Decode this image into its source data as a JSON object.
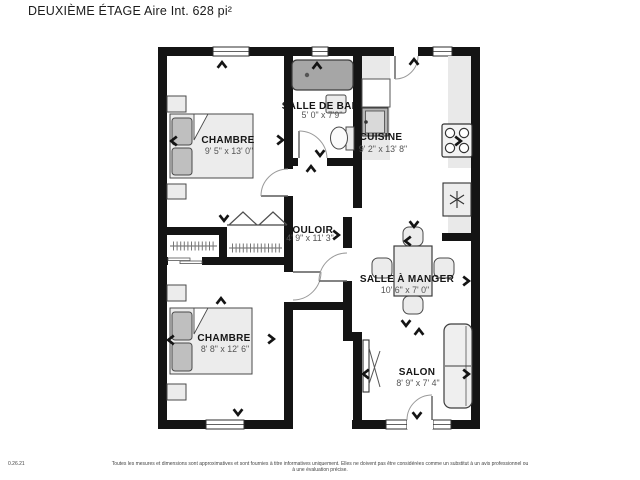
{
  "title": "DEUXIÈME ÉTAGE Aire Int. 628 pi²",
  "plan": {
    "rooms": [
      {
        "id": "chambre-1",
        "name": "CHAMBRE",
        "dims": "9' 5\" x 13' 0\""
      },
      {
        "id": "salle-de-bain",
        "name": "SALLE DE BAIN",
        "dims": "5' 0\" x 7'9\""
      },
      {
        "id": "cuisine",
        "name": "CUISINE",
        "dims": "9' 2\" x 13' 8\""
      },
      {
        "id": "couloir",
        "name": "COULOIR",
        "dims": "4' 9\" x 11' 3\""
      },
      {
        "id": "salle-a-manger",
        "name": "SALLE À MANGER",
        "dims": "10' 6\" x 7' 0\""
      },
      {
        "id": "chambre-2",
        "name": "CHAMBRE",
        "dims": "8' 8\" x 12' 6\""
      },
      {
        "id": "salon",
        "name": "SALON",
        "dims": "8' 9\" x 7' 4\""
      }
    ],
    "fixtures": [
      "bathtub",
      "toilet",
      "vanity-sink",
      "kitchen-sink",
      "stove",
      "refrigerator",
      "dining-table",
      "dining-chairs",
      "sofa",
      "tv",
      "beds",
      "nightstands",
      "closets"
    ],
    "camera_arrows": [
      {
        "x": 222,
        "y": 65,
        "dir": "up"
      },
      {
        "x": 280,
        "y": 140,
        "dir": "right"
      },
      {
        "x": 174,
        "y": 141,
        "dir": "left"
      },
      {
        "x": 317,
        "y": 66,
        "dir": "up"
      },
      {
        "x": 320,
        "y": 153,
        "dir": "down"
      },
      {
        "x": 311,
        "y": 169,
        "dir": "up"
      },
      {
        "x": 414,
        "y": 62,
        "dir": "up"
      },
      {
        "x": 458,
        "y": 141,
        "dir": "right"
      },
      {
        "x": 336,
        "y": 235,
        "dir": "right"
      },
      {
        "x": 224,
        "y": 218,
        "dir": "down"
      },
      {
        "x": 221,
        "y": 301,
        "dir": "up"
      },
      {
        "x": 414,
        "y": 224,
        "dir": "down"
      },
      {
        "x": 408,
        "y": 241,
        "dir": "left"
      },
      {
        "x": 466,
        "y": 281,
        "dir": "right"
      },
      {
        "x": 406,
        "y": 323,
        "dir": "down"
      },
      {
        "x": 419,
        "y": 332,
        "dir": "up"
      },
      {
        "x": 366,
        "y": 374,
        "dir": "left"
      },
      {
        "x": 466,
        "y": 374,
        "dir": "right"
      },
      {
        "x": 417,
        "y": 415,
        "dir": "down"
      },
      {
        "x": 171,
        "y": 340,
        "dir": "left"
      },
      {
        "x": 271,
        "y": 339,
        "dir": "right"
      },
      {
        "x": 238,
        "y": 412,
        "dir": "down"
      }
    ]
  },
  "footer": {
    "version": "0.26.21",
    "disclaimer": "Toutes les mesures et dimensions sont approximatives et sont fournies à titre informatives uniquement. Elles ne doivent pas être considérées comme un substitut à un avis professionnel ou à une évaluation précise."
  },
  "colors": {
    "wall": "#141414",
    "furniture_fill": "#ececec",
    "furniture_stroke": "#4a4a4a",
    "tub_fill": "#a6a6a6",
    "counter_fill": "#e9e9e9",
    "room_name_text": "#161616",
    "dim_text": "#555555"
  }
}
